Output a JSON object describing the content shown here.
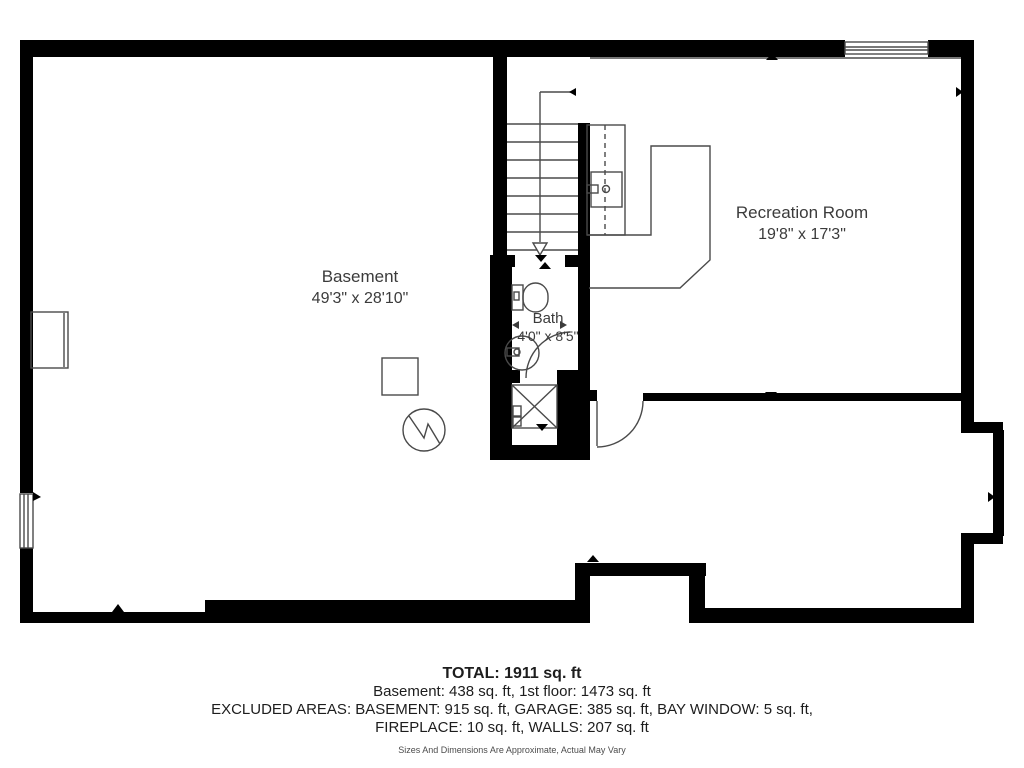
{
  "plan": {
    "rooms": [
      {
        "name": "Basement",
        "dimensions": "49'3\" x 28'10\""
      },
      {
        "name": "Recreation Room",
        "dimensions": "19'8\" x 17'3\""
      },
      {
        "name": "Bath",
        "dimensions": "4'0\" x 8'5\""
      }
    ],
    "footer": {
      "total": "TOTAL: 1911 sq. ft",
      "line1": "Basement: 438 sq. ft, 1st floor: 1473 sq. ft",
      "line2": "EXCLUDED AREAS: BASEMENT: 915 sq. ft, GARAGE: 385 sq. ft, BAY WINDOW: 5 sq. ft,",
      "line3": "FIREPLACE: 10 sq. ft, WALLS: 207 sq. ft",
      "disclaimer": "Sizes And Dimensions Are Approximate, Actual May Vary"
    },
    "colors": {
      "wall": "#000000",
      "thin_line": "#4a4a4a",
      "background": "#ffffff"
    }
  }
}
